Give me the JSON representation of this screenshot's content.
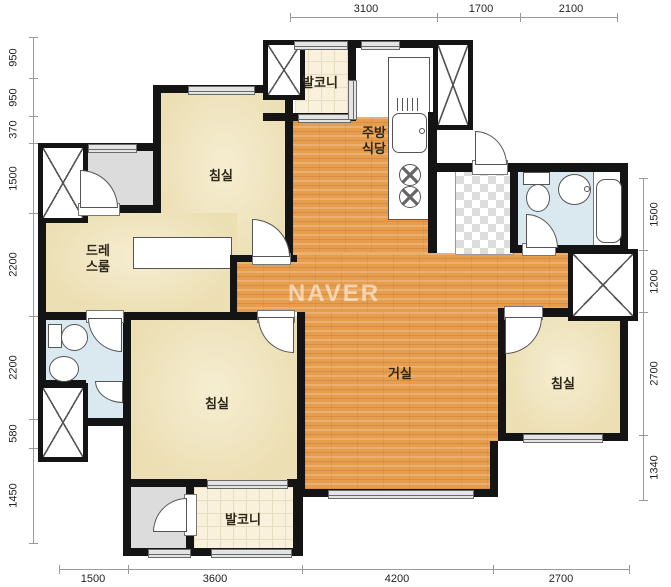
{
  "watermark": "NAVER",
  "rooms": {
    "bedroom_top_left": "침실",
    "bedroom_bottom_left": "침실",
    "bedroom_right": "침실",
    "living_room": "거실",
    "kitchen_line1": "주방",
    "kitchen_line2": "식당",
    "dressroom_line1": "드레",
    "dressroom_line2": "스룸",
    "balcony_top": "발코니",
    "balcony_bottom": "발코니"
  },
  "dimensions": {
    "top": [
      "3100",
      "1700",
      "2100"
    ],
    "left": [
      "950",
      "950",
      "370",
      "1500",
      "2200",
      "2200",
      "580",
      "1450"
    ],
    "right": [
      "1500",
      "1200",
      "2700",
      "1340"
    ],
    "bottom": [
      "1500",
      "3600",
      "4200",
      "2700"
    ]
  },
  "colors": {
    "wall": "#141414",
    "wood_floor": "#e69d4e",
    "room_cream": "#f0e4bf",
    "bath_blue": "#d9e9ef",
    "balcony_tile": "#f9f1dc",
    "utility_gray": "#dcdcdc"
  }
}
